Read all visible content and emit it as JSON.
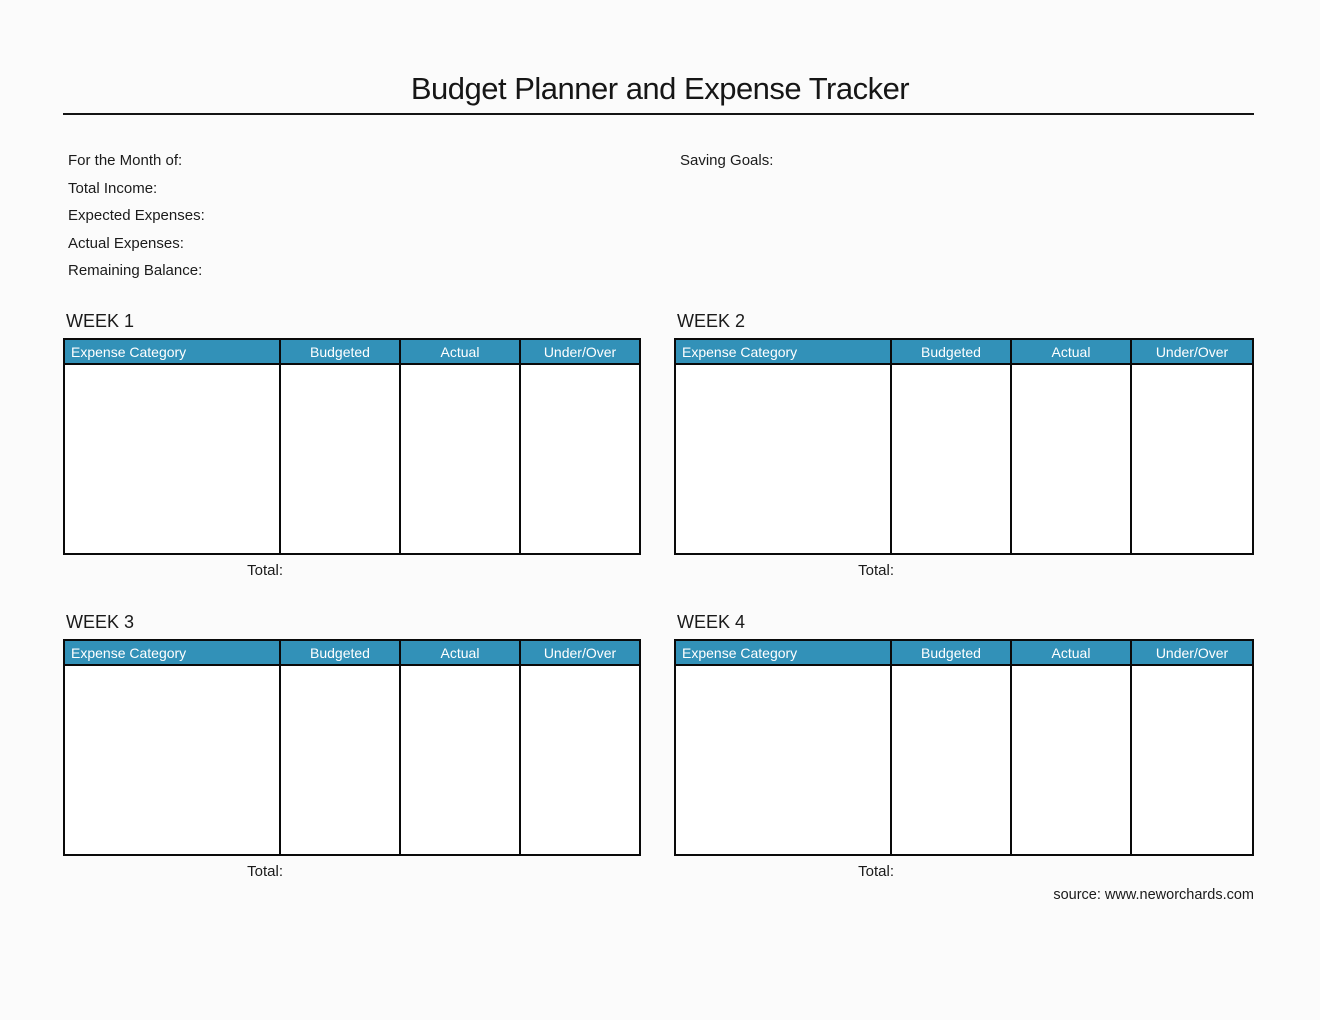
{
  "page": {
    "title": "Budget Planner and Expense Tracker",
    "source_credit": "source: www.neworchards.com"
  },
  "summary": {
    "fields": [
      {
        "label": "For the Month of:"
      },
      {
        "label": "Total Income:"
      },
      {
        "label": "Expected Expenses:"
      },
      {
        "label": "Actual Expenses:"
      },
      {
        "label": "Remaining Balance:"
      }
    ],
    "saving_goals_label": "Saving Goals:"
  },
  "tables": {
    "columns": [
      "Expense Category",
      "Budgeted",
      "Actual",
      "Under/Over"
    ],
    "total_label": "Total:",
    "weeks": [
      {
        "label": "WEEK 1"
      },
      {
        "label": "WEEK 2"
      },
      {
        "label": "WEEK 3"
      },
      {
        "label": "WEEK 4"
      }
    ],
    "colors": {
      "header_bg": "#3291B8",
      "header_text": "#FFFFFF",
      "border": "#0A0A0A"
    }
  }
}
